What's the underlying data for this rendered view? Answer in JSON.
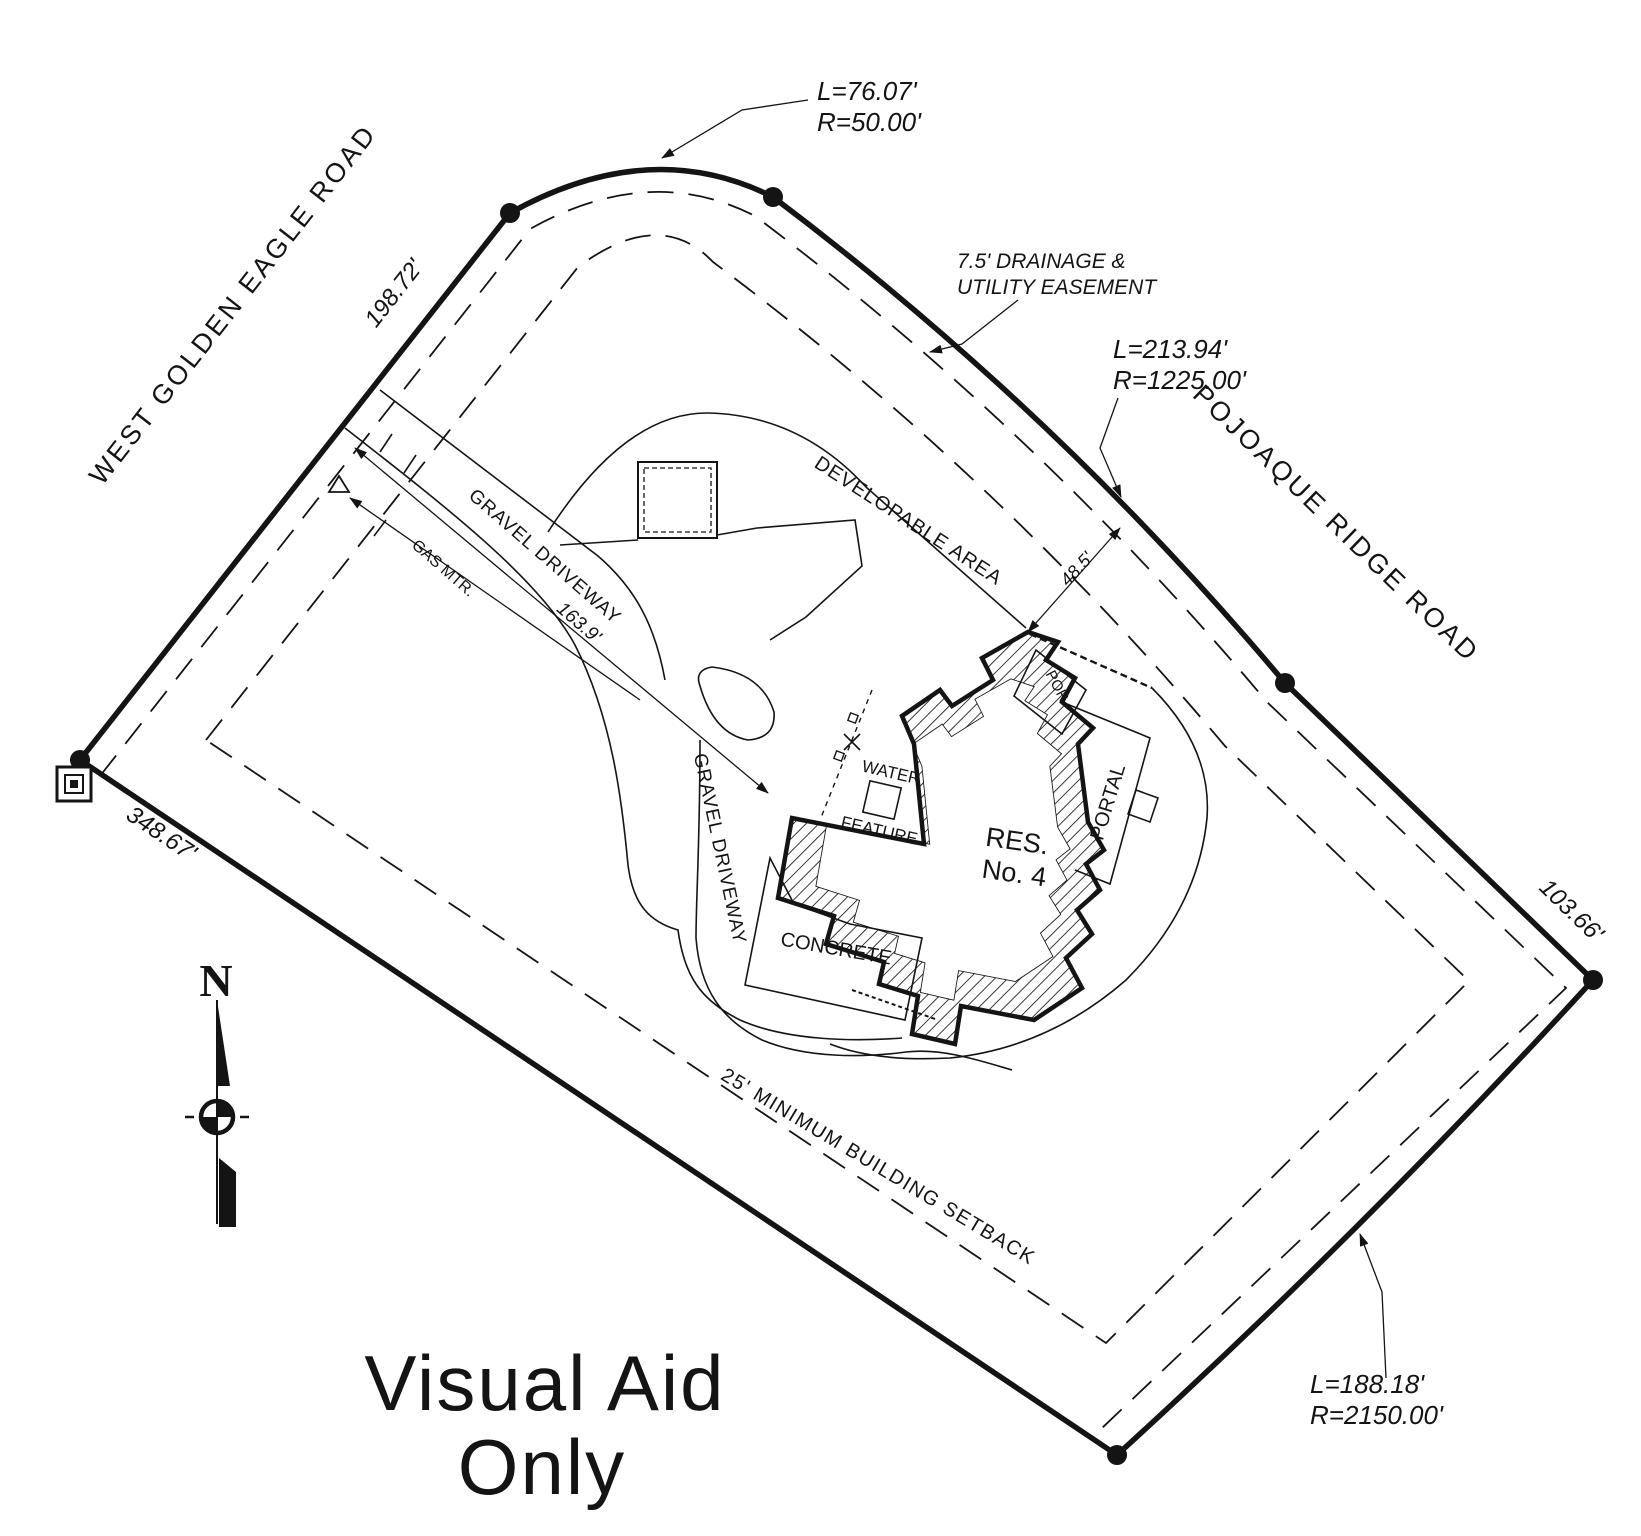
{
  "colors": {
    "ink": "#141414",
    "background": "#ffffff"
  },
  "roads": {
    "west": "WEST GOLDEN EAGLE ROAD",
    "east": "POJOAQUE RIDGE ROAD"
  },
  "dimensions": {
    "northwest": "198.72'",
    "southwest": "348.67'",
    "east": "103.66'",
    "driveway": "163.9'",
    "house_to_line": "48.5'"
  },
  "curves": {
    "north": {
      "length": "L=76.07'",
      "radius": "R=50.00'"
    },
    "northeast": {
      "length": "L=213.94'",
      "radius": "R=1225.00'"
    },
    "southeast": {
      "length": "L=188.18'",
      "radius": "R=2150.00'"
    }
  },
  "notes": {
    "easement_line1": "7.5' DRAINAGE &",
    "easement_line2": "UTILITY EASEMENT",
    "setback": "25' MINIMUM BUILDING SETBACK",
    "developable": "DEVELOPABLE AREA",
    "gas_meter": "GAS MTR."
  },
  "features": {
    "driveway_upper": "GRAVEL DRIVEWAY",
    "driveway_lower": "GRAVEL DRIVEWAY",
    "water_line1": "WATER",
    "water_line2": "FEATURE",
    "residence_line1": "RES.",
    "residence_line2": "No. 4",
    "portal": "PORTAL",
    "porch": "POR.",
    "concrete": "CONCRETE"
  },
  "compass": {
    "north": "N"
  },
  "watermark": {
    "line1": "Visual Aid",
    "line2": "Only"
  }
}
